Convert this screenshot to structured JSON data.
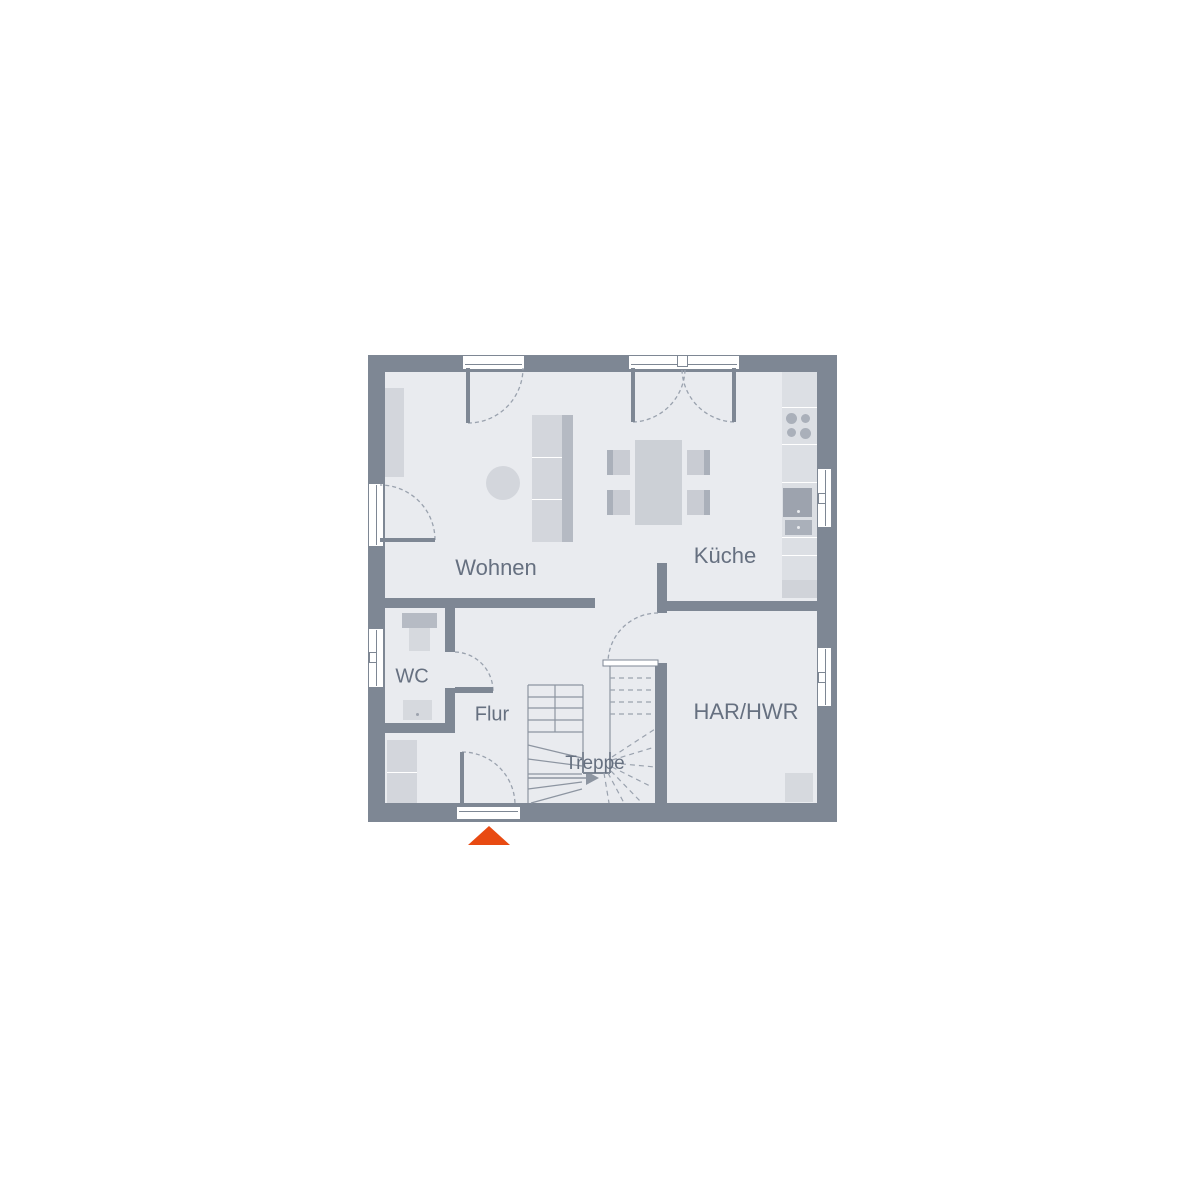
{
  "rooms": {
    "living": "Wohnen",
    "kitchen": "Küche",
    "wc": "WC",
    "hallway": "Flur",
    "stairs": "Treppe",
    "utility": "HAR/HWR"
  },
  "colors": {
    "bg": "#ffffff",
    "wall": "#7e8794",
    "floor": "#e9ebef",
    "furniture": "#d3d6dc",
    "furniture-mid": "#c9ccd3",
    "furniture-dark": "#aab0ba",
    "sofa-back": "#b5bac3",
    "table": "#ccd0d6",
    "counter": "#dcdfe4",
    "counter-end": "#d0d3d9",
    "appliance": "#9da3ae",
    "fixture": "#d6d9de",
    "cistern": "#b6bbc4",
    "line": "#8d95a1",
    "dash": "#9aa2ae",
    "opening": "#ffffff",
    "text": "#667080",
    "marker": "#e84a12"
  }
}
